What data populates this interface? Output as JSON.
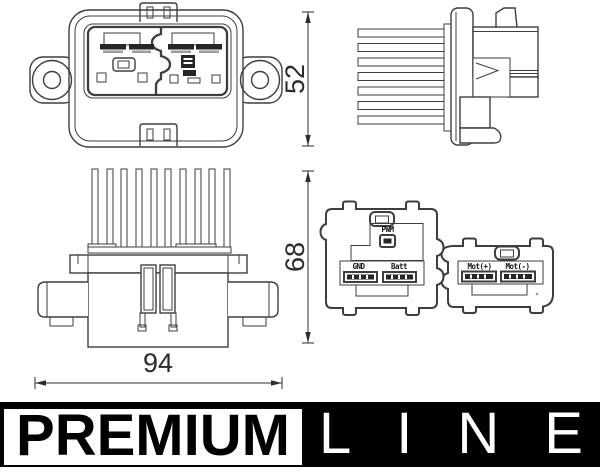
{
  "product_drawing": {
    "dim_top_view_height": "52",
    "dim_front_view_height": "68",
    "dim_width": "94",
    "connector_labels": {
      "pwm": "PWM",
      "gnd": "GND",
      "batt": "Batt",
      "mot_plus": "Mot(+)",
      "mot_minus": "Mot(-)"
    }
  },
  "branding": {
    "premium": "PREMIUM",
    "line": "LINE"
  },
  "colors": {
    "line_art": "#3e3e3e",
    "dark_fill": "#262626",
    "dimension_text": "#2b2b2b",
    "banner_bg": "#000000",
    "premium_box_bg": "#ffffff"
  }
}
